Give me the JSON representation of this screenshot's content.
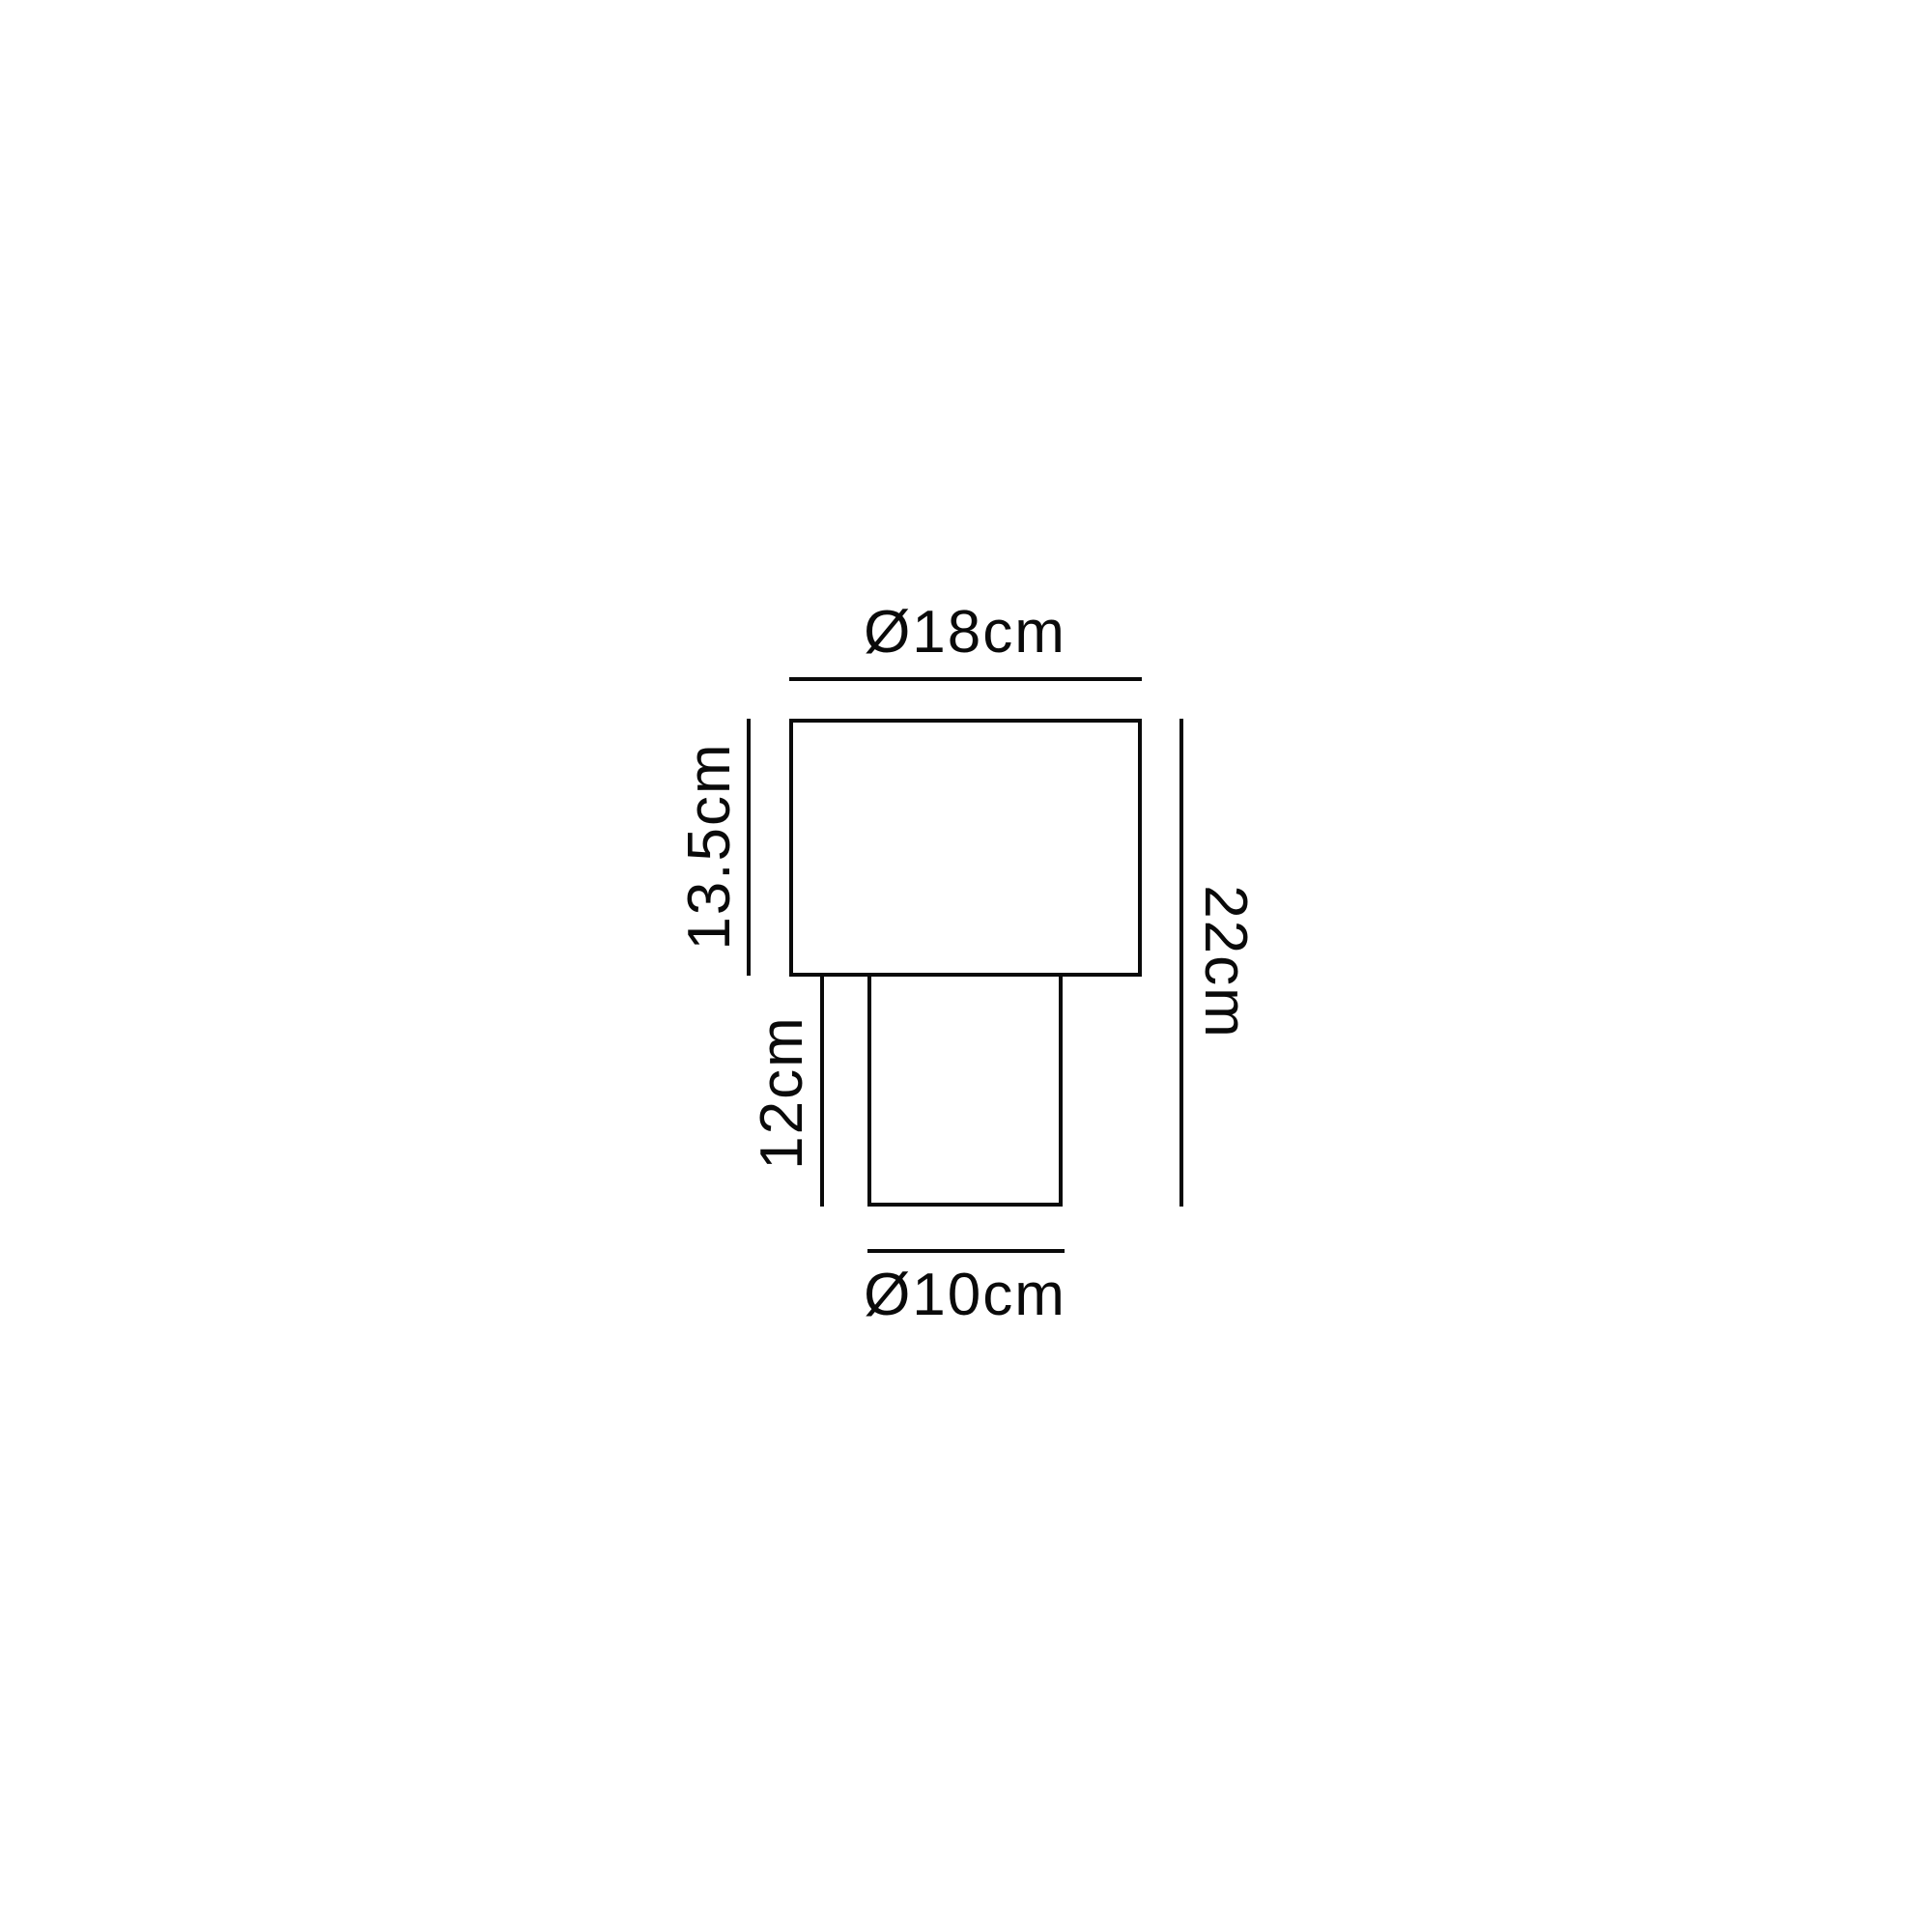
{
  "diagram": {
    "kind": "lamp-dimension-drawing",
    "dimensions": {
      "shade_diameter": "Ø18cm",
      "shade_height": "13.5cm",
      "base_height": "12cm",
      "total_height": "22cm",
      "base_diameter": "Ø10cm"
    },
    "colors": {
      "line": "#0a0a0a",
      "background": "#ffffff"
    }
  }
}
